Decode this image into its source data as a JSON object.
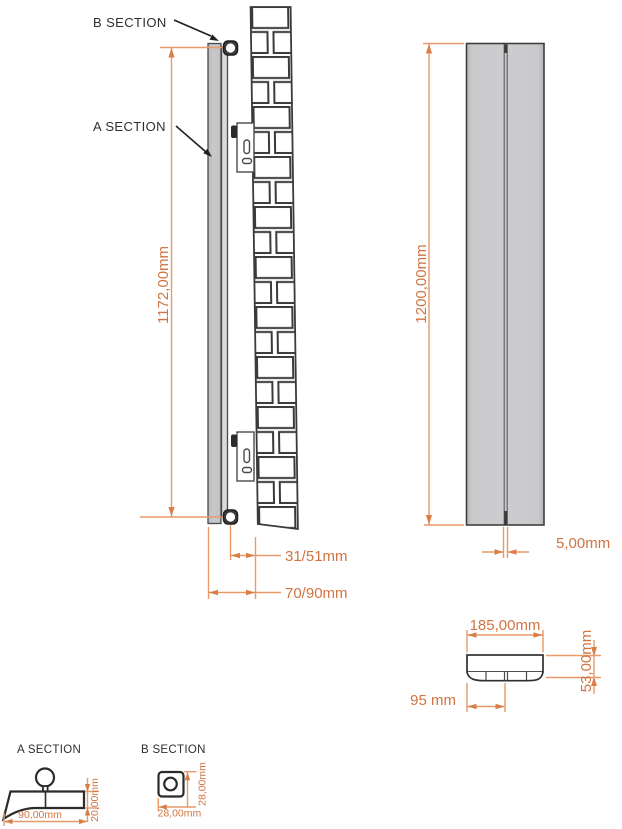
{
  "drawing": {
    "side_view": {
      "b_section_callout": "B SECTION",
      "a_section_callout": "A SECTION",
      "height_dim": "1172,00mm",
      "pipe_wall_dim": "31/51mm",
      "panel_wall_dim": "70/90mm"
    },
    "front_view": {
      "height_dim": "1200,00mm",
      "gap_dim": "5,00mm"
    },
    "top_view": {
      "width_dim": "185,00mm",
      "depth_dim": "53,00mm",
      "center_dim": "95 mm"
    },
    "a_section_detail": {
      "title": "A SECTION",
      "width_dim": "90,00mm",
      "thickness_dim": "20,00mm"
    },
    "b_section_detail": {
      "title": "B SECTION",
      "width_dim": "28,00mm",
      "height_dim": "28,00mm"
    },
    "colors": {
      "dimension_text": "#cf7442",
      "dimension_line": "#e89a68",
      "drawing_line": "#2f2f2f",
      "panel_fill": "#c7c7c9"
    }
  }
}
